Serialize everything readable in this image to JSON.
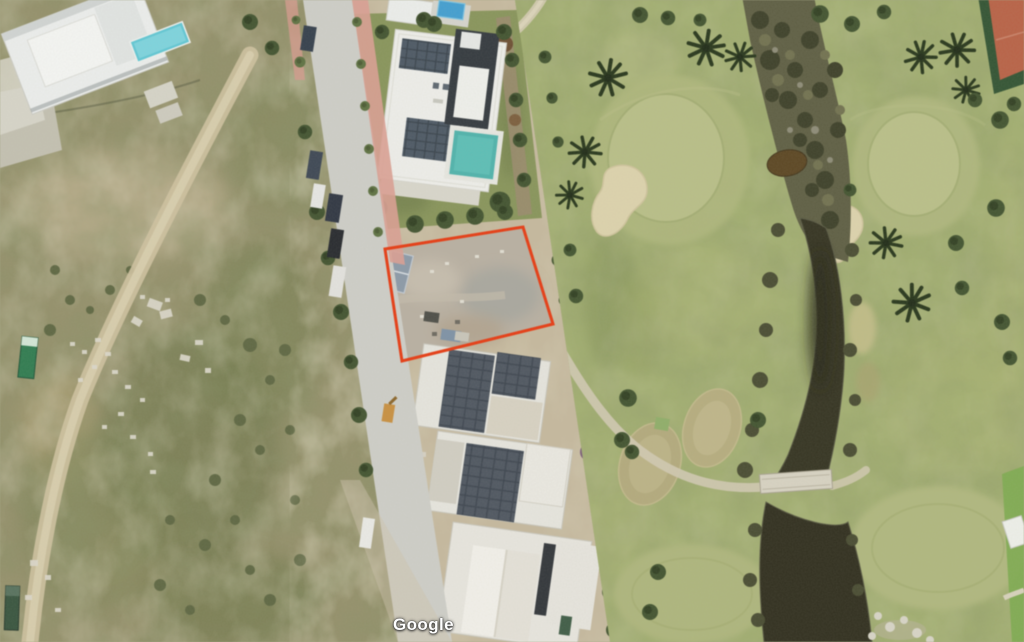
{
  "map": {
    "watermark": "Google",
    "view": "satellite",
    "annotation": {
      "plot_outline_points": "385,249 523,227 553,324 402,361",
      "plot_outline_color": "#e8380f"
    },
    "colors": {
      "plot_outline": "#e8380f",
      "scrub": "#94906a",
      "scrub_green": "#757d4e",
      "scrub_tan": "#b3a883",
      "road": "#cfcfc9",
      "sidewalk_pink": "#dc9e92",
      "dirt": "#c6b99e",
      "lawn": "#879459",
      "golf_grass": "#a2af70",
      "golf_fairway": "#b9bf87",
      "sand_bunker": "#ded4ad",
      "creek_water": "#31301e",
      "pond_water": "#2d2b1b",
      "creek_trees": "#5c5c41",
      "building_white": "#f0f0ec",
      "solar_panel": "#434e59",
      "pool_teal": "#4db3ac",
      "pool_blue": "#3f9ed2",
      "tennis_clay": "#b96044",
      "palm_tree": "#243318",
      "cart_path": "#d5ccb2",
      "bridge": "#d9d4c4"
    }
  }
}
